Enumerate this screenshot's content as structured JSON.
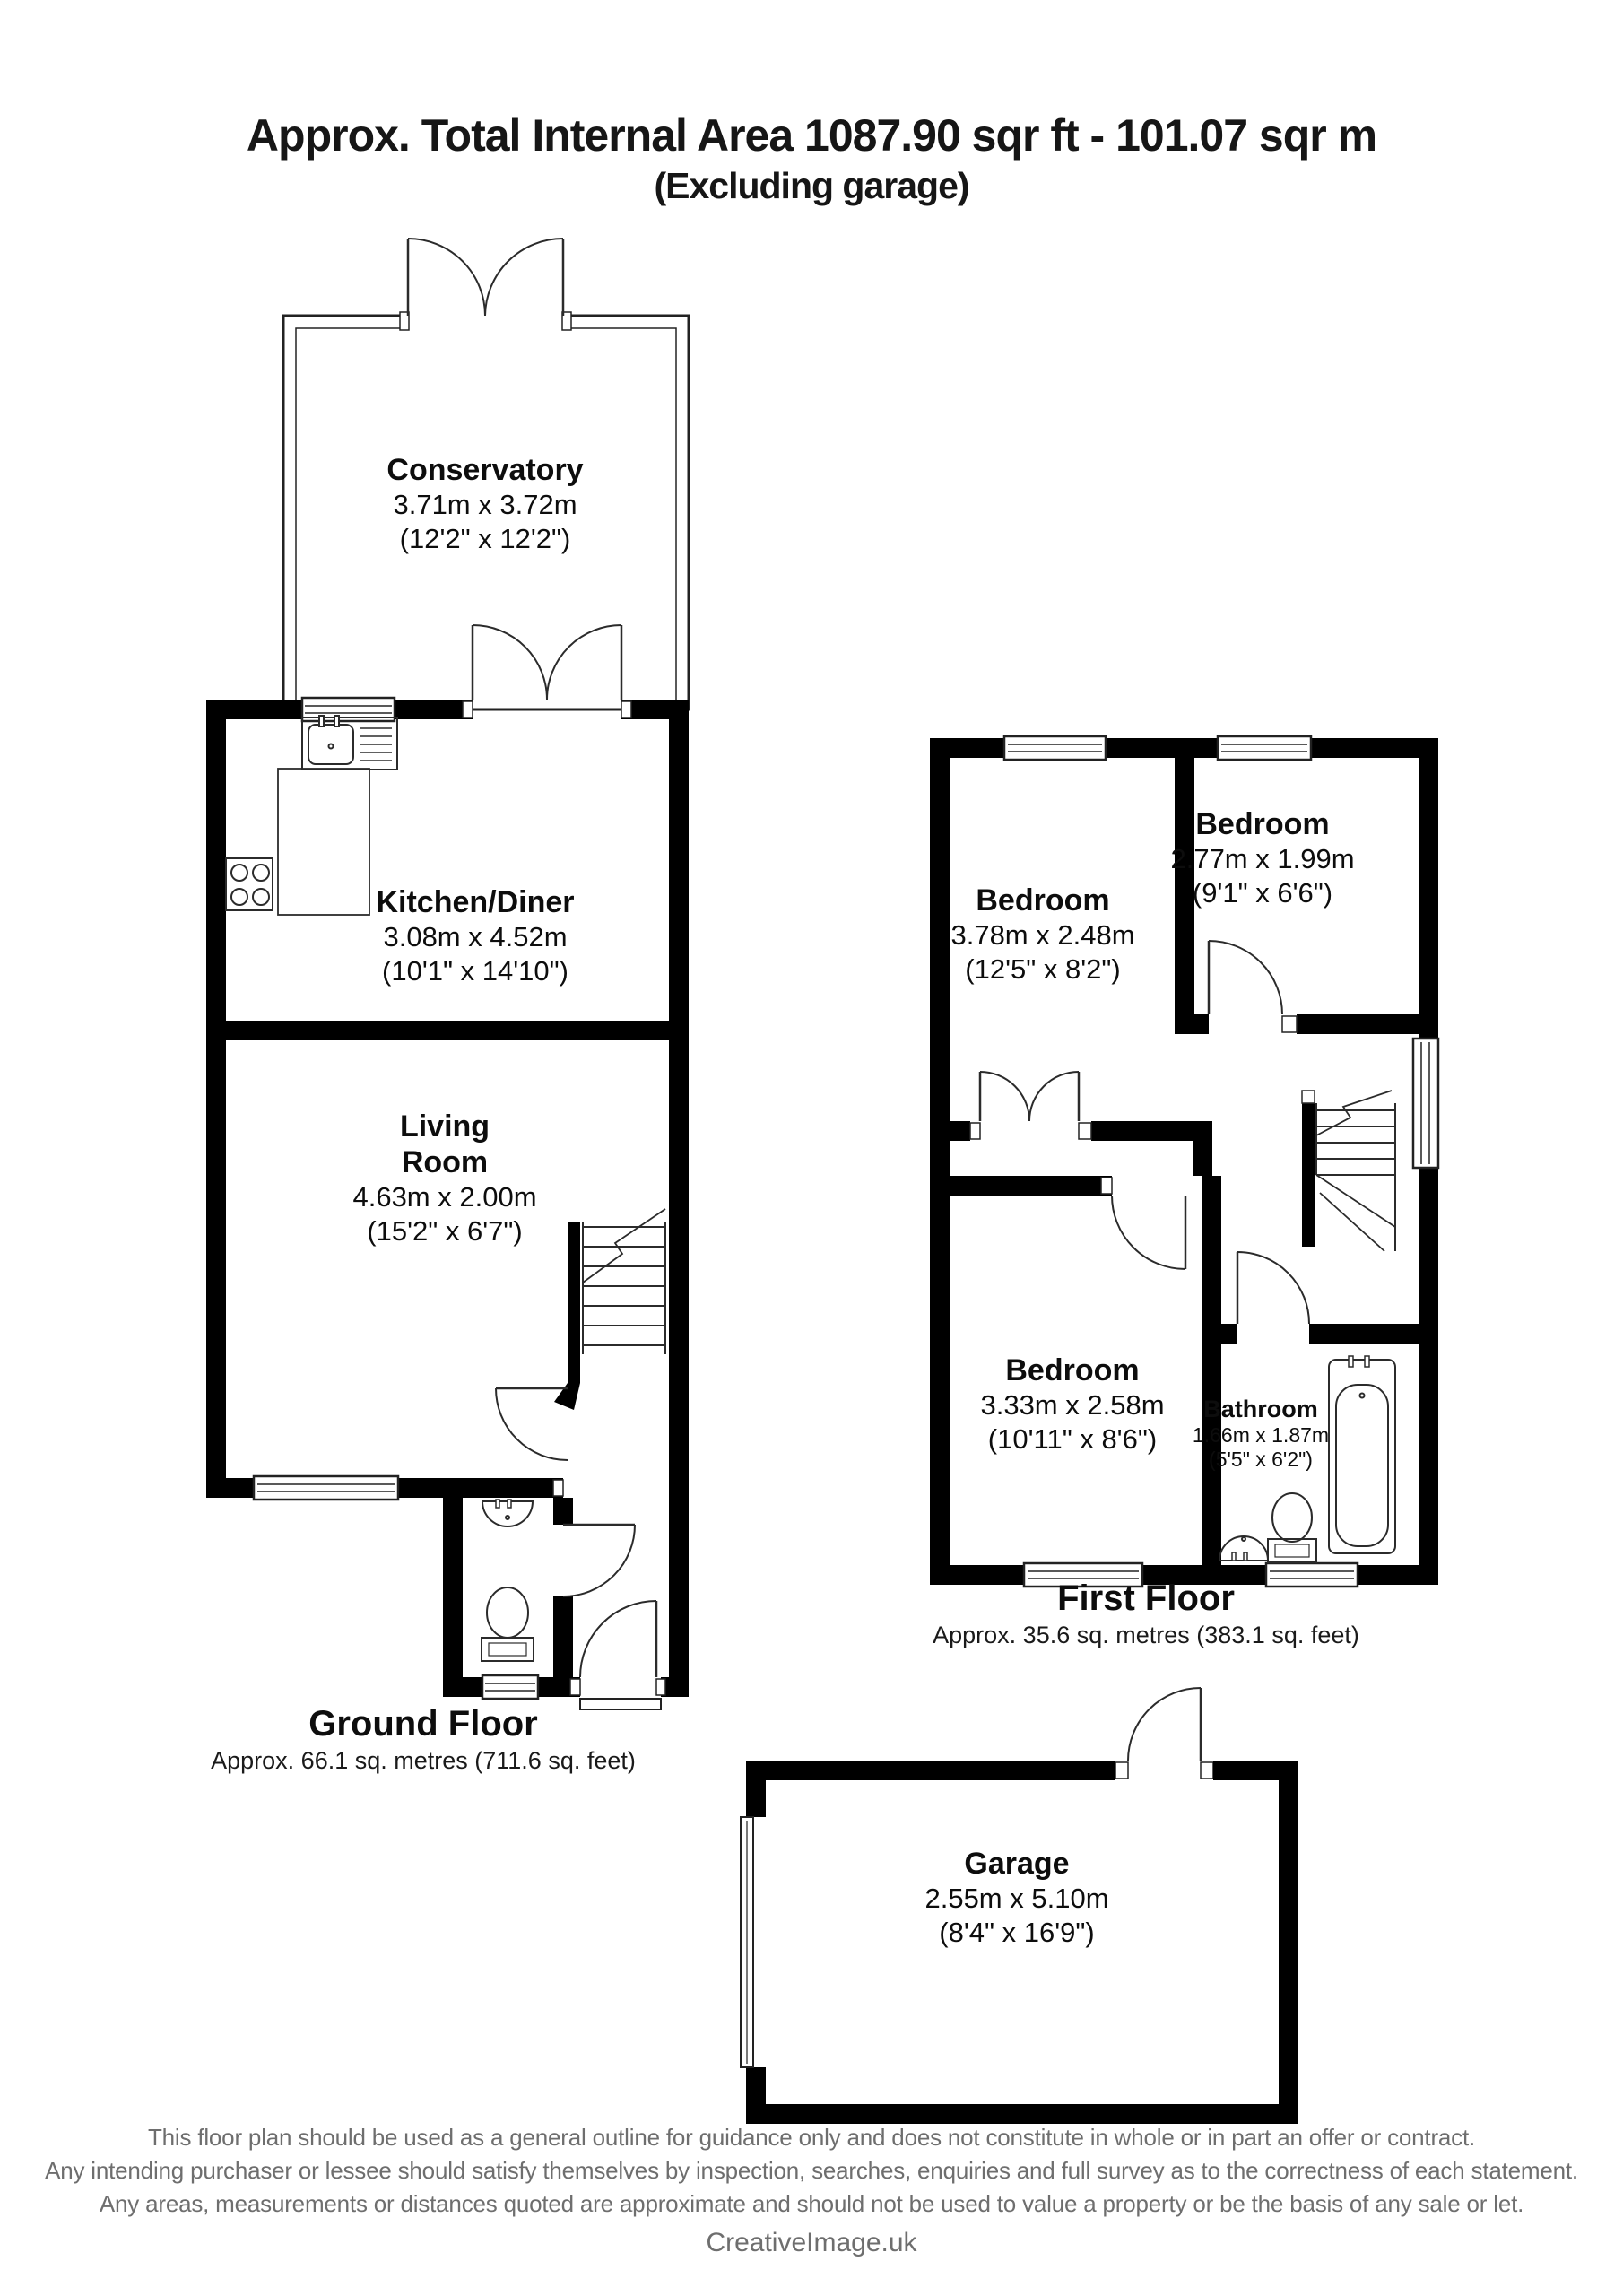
{
  "title": {
    "line1": "Approx. Total Internal Area 1087.90 sqr ft - 101.07 sqr m",
    "line2": "(Excluding garage)"
  },
  "ground_floor": {
    "label": "Ground Floor",
    "area": "Approx. 66.1 sq. metres (711.6 sq. feet)",
    "rooms": {
      "conservatory": {
        "name": "Conservatory",
        "metric": "3.71m x 3.72m",
        "imperial": "(12'2\" x 12'2\")"
      },
      "kitchen": {
        "name": "Kitchen/Diner",
        "metric": "3.08m x 4.52m",
        "imperial": "(10'1\" x 14'10\")"
      },
      "living": {
        "name_line1": "Living",
        "name_line2": "Room",
        "metric": "4.63m x 2.00m",
        "imperial": "(15'2\" x 6'7\")"
      }
    }
  },
  "first_floor": {
    "label": "First Floor",
    "area": "Approx. 35.6 sq. metres (383.1 sq. feet)",
    "rooms": {
      "bedroom_top_left": {
        "name": "Bedroom",
        "metric": "3.78m x 2.48m",
        "imperial": "(12'5\" x 8'2\")"
      },
      "bedroom_top_right": {
        "name": "Bedroom",
        "metric": "2.77m x 1.99m",
        "imperial": "(9'1\" x 6'6\")"
      },
      "bedroom_bottom": {
        "name": "Bedroom",
        "metric": "3.33m x 2.58m",
        "imperial": "(10'11\" x 8'6\")"
      },
      "bathroom": {
        "name": "Bathroom",
        "metric": "1.66m x 1.87m",
        "imperial": "(5'5\" x 6'2\")"
      }
    }
  },
  "garage": {
    "name": "Garage",
    "metric": "2.55m x 5.10m",
    "imperial": "(8'4\" x 16'9\")"
  },
  "footer": {
    "line1": "This floor plan should be used as a general outline for guidance only and does not constitute in whole or in part an offer or contract.",
    "line2": "Any intending purchaser or lessee should satisfy themselves by inspection, searches, enquiries and full survey as to the correctness of each statement.",
    "line3": "Any areas, measurements or distances quoted are approximate and should not be used to value a property or be the basis of any sale or let.",
    "credit": "CreativeImage.uk"
  },
  "colors": {
    "wall": "#000000",
    "line": "#2b2b2b",
    "text": "#0d0d0d",
    "footer_text": "#6e6e6e"
  }
}
